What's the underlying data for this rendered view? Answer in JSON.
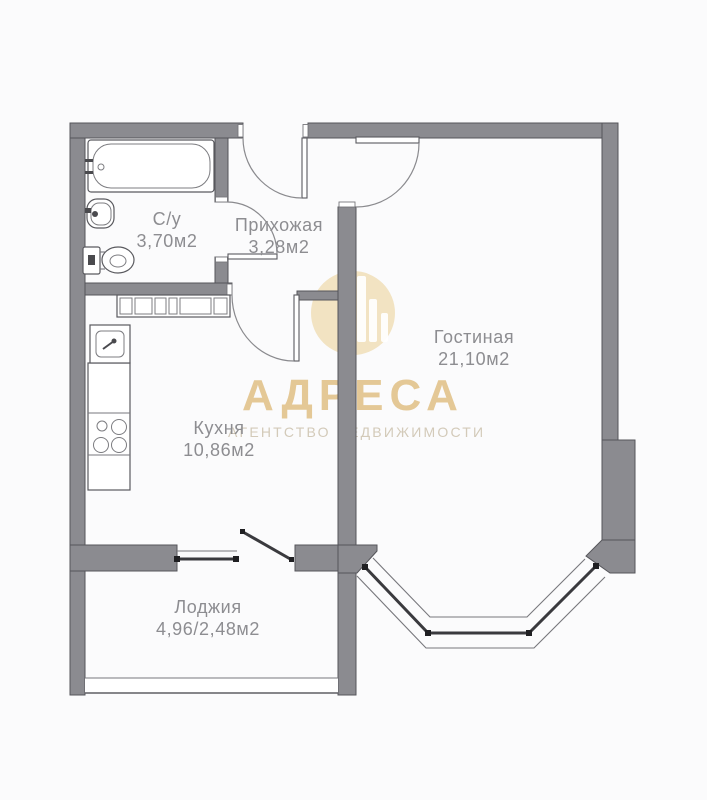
{
  "rooms": {
    "bathroom": {
      "name": "С/у",
      "area": "3,70м2"
    },
    "hallway": {
      "name": "Прихожая",
      "area": "3,28м2"
    },
    "living_room": {
      "name": "Гостиная",
      "area": "21,10м2"
    },
    "kitchen": {
      "name": "Кухня",
      "area": "10,86м2"
    },
    "loggia": {
      "name": "Лоджия",
      "area": "4,96/2,48м2"
    }
  },
  "watermark": {
    "brand": "АДРЕСА",
    "tagline": "АГЕНТСТВО НЕДВИЖИМОСТИ"
  },
  "colors": {
    "wall": "#8b8b90",
    "outline": "#55555a",
    "label_text": "#8d8d91",
    "watermark_gold": "#e0c187",
    "glazing": "#3a3a3e",
    "background": "#fbfbfc"
  }
}
